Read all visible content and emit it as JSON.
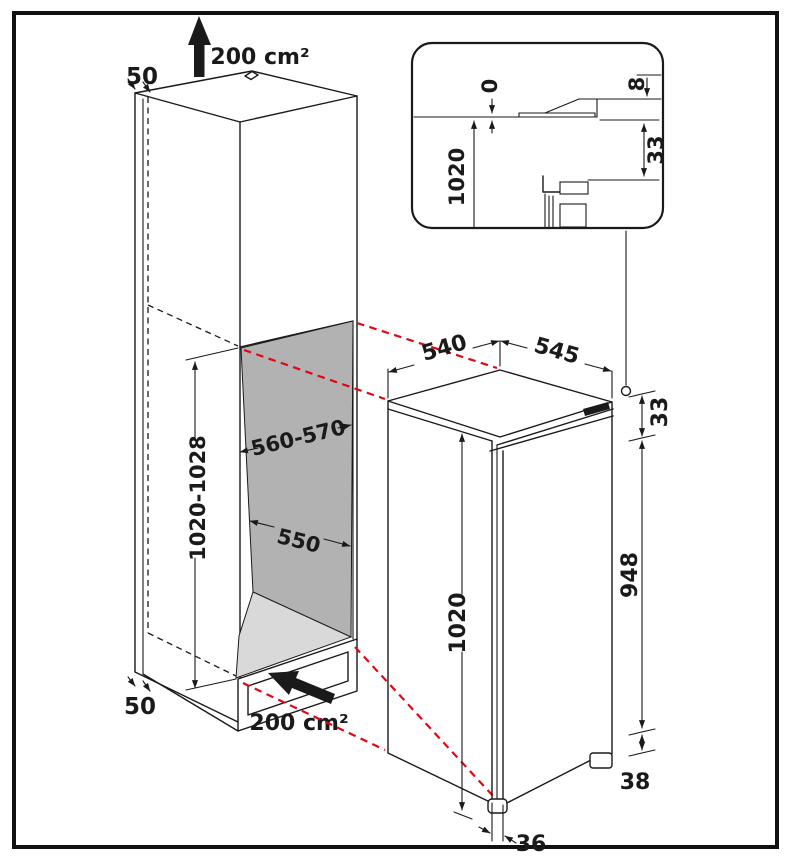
{
  "meta": {
    "description": "Built-in appliance niche installation dimension drawing",
    "colors": {
      "line": "#1a1a1a",
      "projection_red": "#e30613",
      "niche_back_panel": "#b2b2b2",
      "niche_floor_panel": "#d9d9d9",
      "background": "#ffffff"
    }
  },
  "cabinet": {
    "top_clearance": "50",
    "top_vent_area": "200 cm²",
    "niche_width": "560-570",
    "niche_depth": "550",
    "niche_height": "1020-1028",
    "bottom_clearance": "50",
    "bottom_vent_area": "200 cm²"
  },
  "appliance": {
    "depth": "540",
    "width": "545",
    "height": "1020",
    "door_height": "948",
    "top_offset": "33",
    "foot_height": "38",
    "door_thickness": "36"
  },
  "inset": {
    "front_gap": "0",
    "top_step": "8",
    "niche_height": "1020",
    "bracket_offset": "33"
  }
}
